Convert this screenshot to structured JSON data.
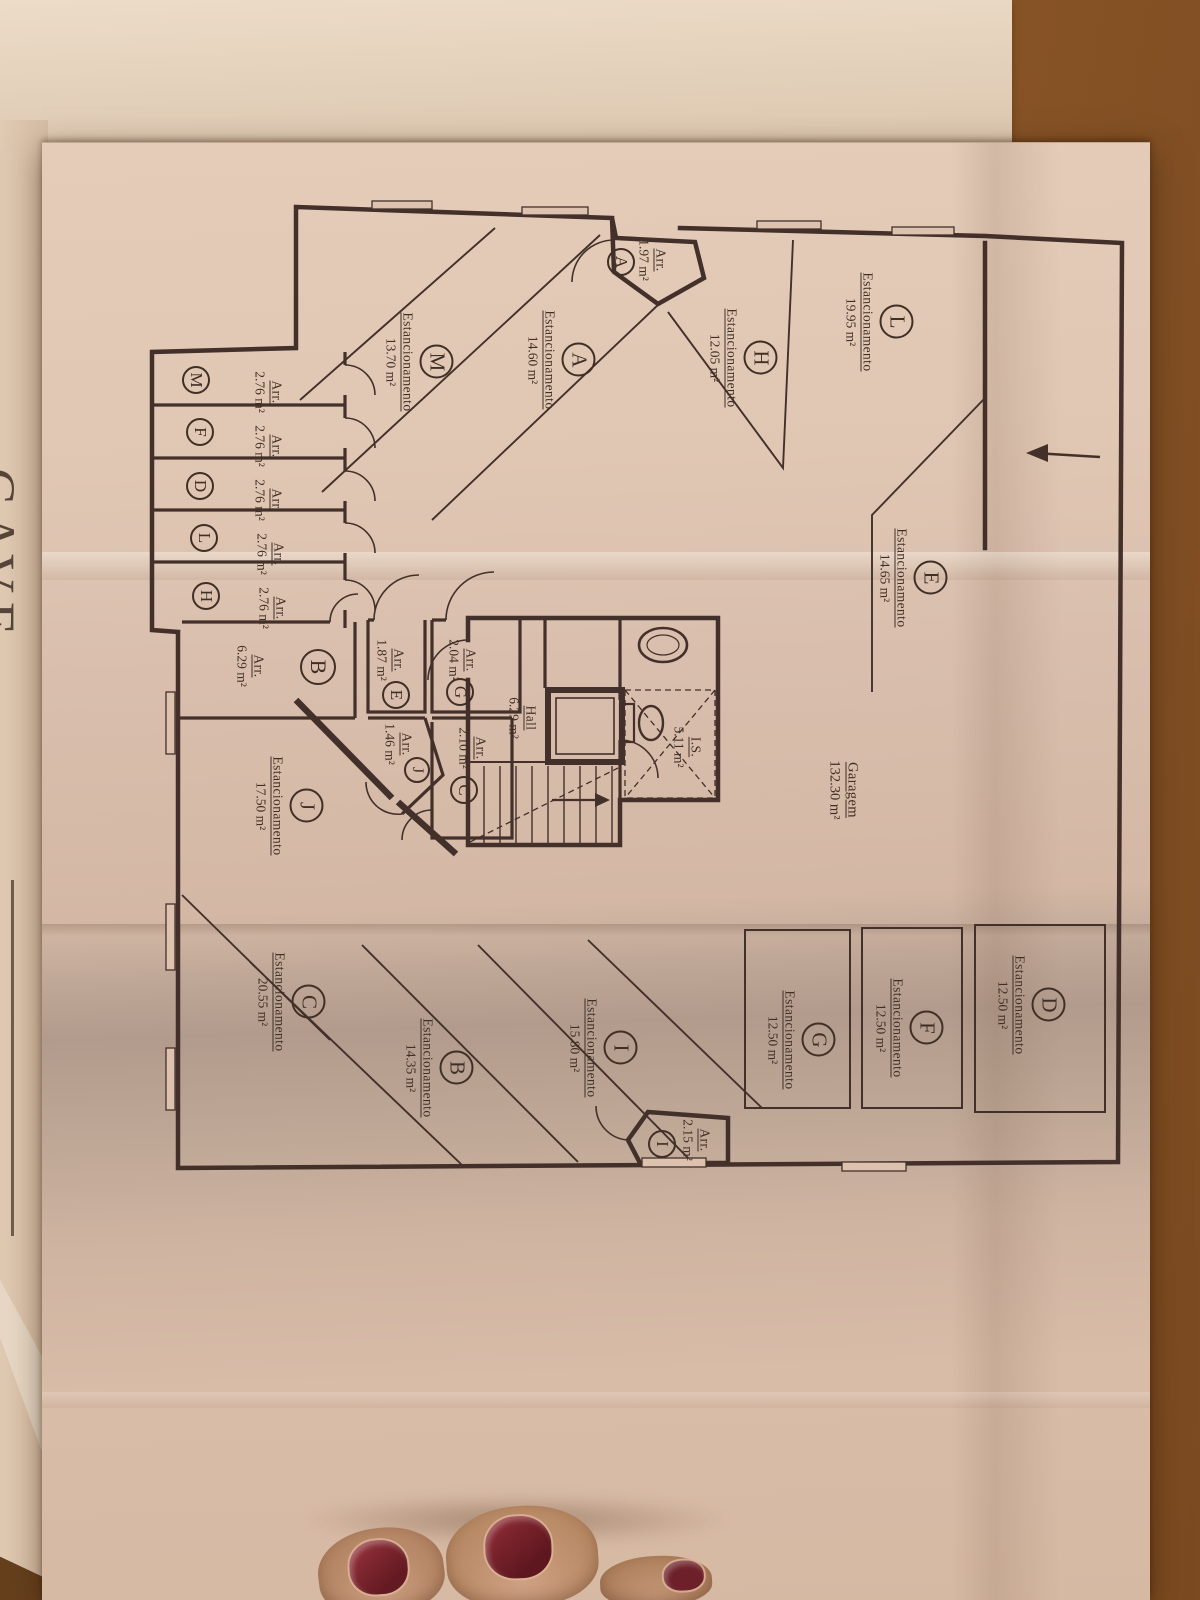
{
  "sheet": {
    "title": "CAVE"
  },
  "labels": {
    "parking": "Estancionamento",
    "storage": "Arr."
  },
  "rooms": {
    "garage": {
      "name": "Garagem",
      "area": "132.30 m²"
    },
    "hall": {
      "name": "Hall",
      "area": "6.29 m²"
    },
    "wc": {
      "name": "I.S.",
      "area": "5.11 m²"
    }
  },
  "parking": [
    {
      "id": "L",
      "area": "19.95 m²"
    },
    {
      "id": "H",
      "area": "12.05 m²"
    },
    {
      "id": "A",
      "area": "14.60 m²"
    },
    {
      "id": "M",
      "area": "13.70 m²"
    },
    {
      "id": "E",
      "area": "14.65 m²"
    },
    {
      "id": "D",
      "area": "12.50 m²"
    },
    {
      "id": "F",
      "area": "12.50 m²"
    },
    {
      "id": "G",
      "area": "12.50 m²"
    },
    {
      "id": "I",
      "area": "15.80 m²"
    },
    {
      "id": "B",
      "area": "14.35 m²"
    },
    {
      "id": "C",
      "area": "20.55 m²"
    },
    {
      "id": "J",
      "area": "17.50 m²"
    }
  ],
  "storage": [
    {
      "id": "A",
      "area": "1.97 m²"
    },
    {
      "id": "M",
      "area": "2.76 m²"
    },
    {
      "id": "F",
      "area": "2.76 m²"
    },
    {
      "id": "D",
      "area": "2.76 m²"
    },
    {
      "id": "L",
      "area": "2.76 m²"
    },
    {
      "id": "H",
      "area": "2.76 m²"
    },
    {
      "id": "B",
      "area": "6.29 m²"
    },
    {
      "id": "E",
      "area": "1.87 m²"
    },
    {
      "id": "G",
      "area": "2.04 m²"
    },
    {
      "id": "J",
      "area": "1.46 m²"
    },
    {
      "id": "C",
      "area": "2.10 m²"
    },
    {
      "id": "I",
      "area": "2.15 m²"
    }
  ]
}
